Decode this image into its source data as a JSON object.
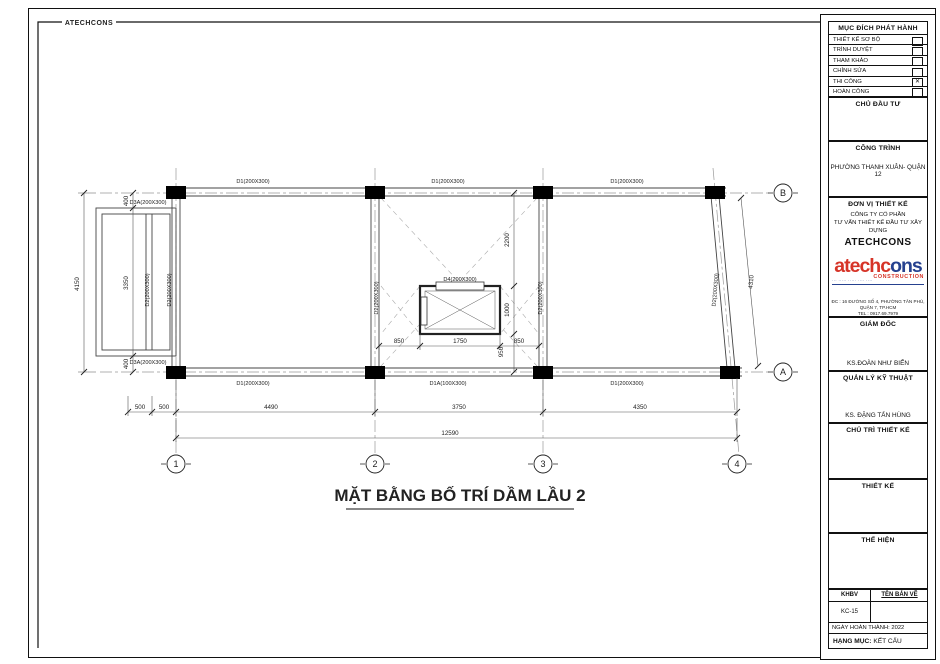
{
  "sheet": {
    "frame_label": "ATECHCONS",
    "title": "MẶT BẰNG BỐ TRÍ DẦM LẦU 2"
  },
  "plan": {
    "labels": {
      "top_beam_1": "D1(200X300)",
      "top_beam_2": "D1(200X300)",
      "top_beam_3": "D1(200X300)",
      "annex_beam_top": "D3A(200X300)",
      "annex_beam_bottom": "D3A(200X300)",
      "shaft_beam": "D4(200X300)",
      "bottom_beam_1": "D1(200X300)",
      "bottom_beam_2": "D1A(100X300)",
      "bottom_beam_3": "D1(200X300)",
      "v_beam_annex_1": "D2(200X300)",
      "v_beam_annex_2": "D2(200X300)",
      "v_beam_grid2": "D2(200X300)",
      "v_beam_grid3": "D2(200X300)",
      "v_beam_grid4": "D2(200X300)"
    },
    "dims": {
      "left_total": "4150",
      "left_top": "400",
      "left_mid": "3350",
      "left_bot": "400",
      "right_top": "2200",
      "right_mid": "1000",
      "right_bot": "950",
      "shaft_left": "850",
      "shaft_mid": "1750",
      "shaft_right": "850",
      "slant": "4310",
      "bot_500a": "500",
      "bot_500b": "500",
      "bot_bay1": "4490",
      "bot_bay2": "3750",
      "bot_bay3": "4350",
      "bot_total": "12590"
    },
    "grids": {
      "c1": "1",
      "c2": "2",
      "c3": "3",
      "c4": "4",
      "rA": "A",
      "rB": "B"
    }
  },
  "titleblock": {
    "purpose_header": "MỤC ĐÍCH PHÁT HÀNH",
    "purposes": [
      {
        "label": "THIẾT KẾ SƠ BỘ",
        "mark": ""
      },
      {
        "label": "TRÌNH DUYỆT",
        "mark": ""
      },
      {
        "label": "THAM KHẢO",
        "mark": ""
      },
      {
        "label": "CHỈNH SỬA",
        "mark": ""
      },
      {
        "label": "THI CÔNG",
        "mark": "✕"
      },
      {
        "label": "HOÀN CÔNG",
        "mark": ""
      }
    ],
    "investor_header": "CHỦ ĐẦU TƯ",
    "project_header": "CÔNG TRÌNH",
    "project_name": "PHƯỜNG THANH XUÂN- QUẬN 12",
    "designer_header": "ĐƠN VỊ THIẾT KẾ",
    "company_line1": "CÔNG TY CỔ PHẦN",
    "company_line2": "TƯ VẤN THIẾT KẾ ĐẦU TƯ XÂY DỰNG",
    "company_name": "ATECHCONS",
    "logo": {
      "red": "atechc",
      "blue": "ons",
      "sub": "CONSTRUCTION",
      "tagline": "··· ····· ····· ···· ····"
    },
    "address_line1": "ĐC : 16 ĐƯỜNG SỐ 4, PHƯỜNG TÂN PHÚ, QUẬN 7, TP.HCM",
    "address_line2": "TEL : 0917.69.7979",
    "director_header": "GIÁM ĐỐC",
    "director_name": "KS.ĐOÀN NHƯ BIỂN",
    "tech_manager_header": "QUẢN LÝ KỸ THUẬT",
    "tech_manager_name": "KS. ĐẶNG TẤN HÙNG",
    "lead_designer_header": "CHỦ TRÌ THIẾT KẾ",
    "design_header": "THIẾT KẾ",
    "draft_header": "THỂ HIỆN",
    "khbv_label": "KHBV",
    "drawing_name_label": "TÊN BẢN VẼ",
    "drawing_code": "KC-15",
    "completion_label": "NGÀY HOÀN THÀNH: 2022",
    "category_label": "HẠNG MỤC:",
    "category_value": "KẾT CẤU"
  }
}
